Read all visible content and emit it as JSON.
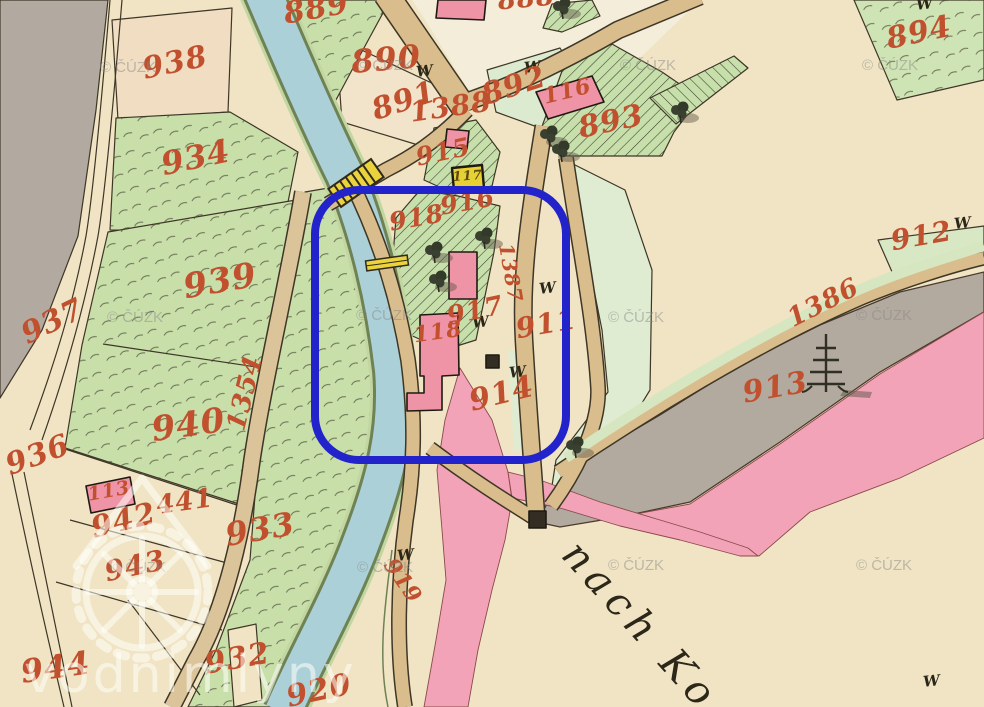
{
  "map": {
    "kind": "historical-cadastral-map",
    "colors": {
      "paper": "#f0e4c4",
      "water": "#abd0d8",
      "meadow": "#c8dfaa",
      "meadow_light": "#dfecd2",
      "road": "#d9bd8c",
      "road_pink": "#f2a3b8",
      "gray_area": "#b2a9a0",
      "label_red": "#c1502e",
      "ink": "#3e3626",
      "highlight_blue": "#2323cc",
      "building_pink": "#ef93a7",
      "building_yellow": "#e7d133"
    },
    "parcel_labels": [
      {
        "t": "889",
        "x": 318,
        "y": 18,
        "r": -10,
        "s": 30
      },
      {
        "t": "888",
        "x": 527,
        "y": 7,
        "r": -5,
        "s": 26
      },
      {
        "t": "894",
        "x": 921,
        "y": 42,
        "r": -12,
        "s": 30
      },
      {
        "t": "938",
        "x": 177,
        "y": 72,
        "r": -12,
        "s": 30
      },
      {
        "t": "890",
        "x": 387,
        "y": 70,
        "r": -5,
        "s": 32
      },
      {
        "t": "892",
        "x": 517,
        "y": 95,
        "r": -18,
        "s": 30
      },
      {
        "t": "116",
        "x": 569,
        "y": 98,
        "r": -14,
        "s": 22
      },
      {
        "t": "891",
        "x": 407,
        "y": 110,
        "r": -18,
        "s": 30
      },
      {
        "t": "1388",
        "x": 452,
        "y": 116,
        "r": -8,
        "s": 28
      },
      {
        "t": "893",
        "x": 613,
        "y": 131,
        "r": -12,
        "s": 30
      },
      {
        "t": "934",
        "x": 198,
        "y": 168,
        "r": -12,
        "s": 32
      },
      {
        "t": "915",
        "x": 445,
        "y": 160,
        "r": -12,
        "s": 25
      },
      {
        "t": "117",
        "x": 468,
        "y": 180,
        "r": -4,
        "s": 13,
        "c": "#5a4a14"
      },
      {
        "t": "916",
        "x": 469,
        "y": 210,
        "r": -10,
        "s": 25
      },
      {
        "t": "918",
        "x": 418,
        "y": 226,
        "r": -10,
        "s": 25
      },
      {
        "t": "912",
        "x": 923,
        "y": 245,
        "r": -10,
        "s": 28
      },
      {
        "t": "939",
        "x": 222,
        "y": 292,
        "r": -10,
        "s": 34
      },
      {
        "t": "937",
        "x": 57,
        "y": 330,
        "r": -26,
        "s": 30
      },
      {
        "t": "1387",
        "x": 504,
        "y": 274,
        "r": 80,
        "s": 20
      },
      {
        "t": "917",
        "x": 477,
        "y": 319,
        "r": -12,
        "s": 26
      },
      {
        "t": "911",
        "x": 548,
        "y": 333,
        "r": -10,
        "s": 28
      },
      {
        "t": "1386",
        "x": 827,
        "y": 310,
        "r": -27,
        "s": 26
      },
      {
        "t": "118",
        "x": 439,
        "y": 339,
        "r": -8,
        "s": 22
      },
      {
        "t": "1354",
        "x": 253,
        "y": 395,
        "r": -76,
        "s": 26
      },
      {
        "t": "940",
        "x": 190,
        "y": 436,
        "r": -8,
        "s": 34
      },
      {
        "t": "913",
        "x": 777,
        "y": 397,
        "r": -10,
        "s": 30
      },
      {
        "t": "914",
        "x": 504,
        "y": 403,
        "r": -14,
        "s": 30
      },
      {
        "t": "936",
        "x": 41,
        "y": 464,
        "r": -20,
        "s": 30
      },
      {
        "t": "113",
        "x": 110,
        "y": 497,
        "r": -10,
        "s": 19
      },
      {
        "t": "441",
        "x": 186,
        "y": 510,
        "r": -8,
        "s": 26
      },
      {
        "t": "942",
        "x": 126,
        "y": 530,
        "r": -14,
        "s": 30
      },
      {
        "t": "933",
        "x": 262,
        "y": 540,
        "r": -10,
        "s": 32
      },
      {
        "t": "943",
        "x": 137,
        "y": 575,
        "r": -12,
        "s": 28
      },
      {
        "t": "919",
        "x": 397,
        "y": 585,
        "r": 55,
        "s": 22
      },
      {
        "t": "932",
        "x": 239,
        "y": 668,
        "r": -10,
        "s": 30
      },
      {
        "t": "944",
        "x": 57,
        "y": 678,
        "r": -8,
        "s": 32
      },
      {
        "t": "920",
        "x": 321,
        "y": 700,
        "r": -12,
        "s": 30
      }
    ],
    "w_symbols": [
      {
        "x": 425,
        "y": 76
      },
      {
        "x": 533,
        "y": 72
      },
      {
        "x": 925,
        "y": 9
      },
      {
        "x": 963,
        "y": 228
      },
      {
        "x": 548,
        "y": 293
      },
      {
        "x": 481,
        "y": 327
      },
      {
        "x": 518,
        "y": 377
      },
      {
        "x": 406,
        "y": 560
      },
      {
        "x": 932,
        "y": 686
      }
    ],
    "tree_symbols": [
      {
        "x": 562,
        "y": 8
      },
      {
        "x": 680,
        "y": 112
      },
      {
        "x": 549,
        "y": 136
      },
      {
        "x": 561,
        "y": 151
      },
      {
        "x": 484,
        "y": 238
      },
      {
        "x": 434,
        "y": 252
      },
      {
        "x": 438,
        "y": 281
      },
      {
        "x": 575,
        "y": 447
      }
    ],
    "conifer_symbols": [
      {
        "x": 826,
        "y": 362
      }
    ],
    "cuzk_watermark": {
      "text": "© ČÚZK",
      "positions": [
        {
          "x": 100,
          "y": 72
        },
        {
          "x": 357,
          "y": 70
        },
        {
          "x": 620,
          "y": 70
        },
        {
          "x": 862,
          "y": 70
        },
        {
          "x": 107,
          "y": 322
        },
        {
          "x": 356,
          "y": 320
        },
        {
          "x": 608,
          "y": 322
        },
        {
          "x": 856,
          "y": 320
        },
        {
          "x": 110,
          "y": 572
        },
        {
          "x": 357,
          "y": 572
        },
        {
          "x": 608,
          "y": 570
        },
        {
          "x": 856,
          "y": 570
        }
      ]
    },
    "route_label": {
      "text": "nach Ko",
      "x": 560,
      "y": 556,
      "rot": 48,
      "size": 40
    },
    "logo_watermark": {
      "text": "vodnimlyny"
    },
    "highlight_box": {
      "x": 315,
      "y": 190,
      "width": 251,
      "height": 270,
      "radius": 44,
      "color": "#2323cc",
      "stroke_width": 8
    }
  }
}
